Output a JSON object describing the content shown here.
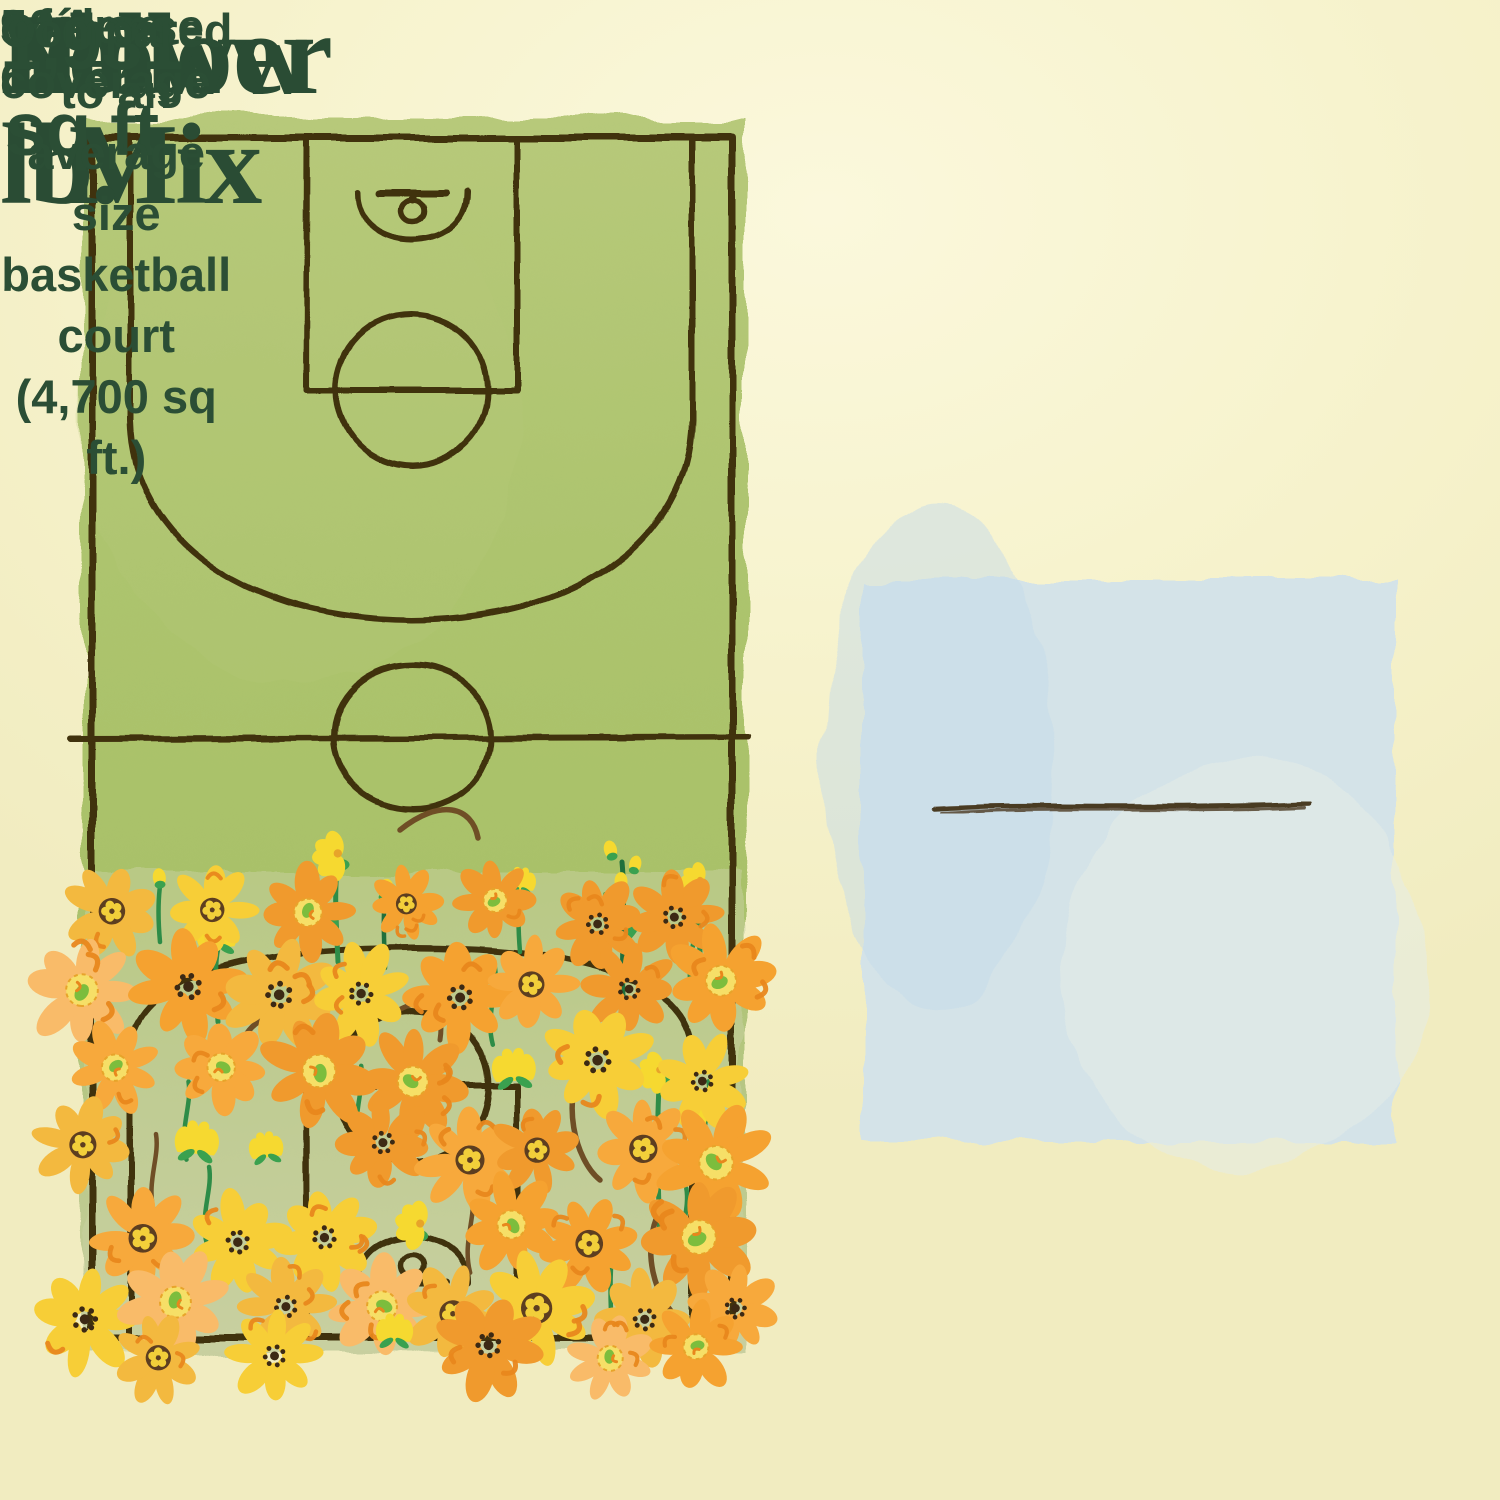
{
  "title": {
    "eyebrow": "Area Coverage:",
    "lines": [
      "Yellow",
      "Flower Mix",
      "1 lb."
    ]
  },
  "stats": {
    "value": "1,931 sq ft.",
    "value_caption": "of dense coverage",
    "comparison": "Compared to an average size basketball court (4,700 sq ft.)"
  },
  "court": {
    "length_label": "94´",
    "width_label": "50´"
  },
  "theme": {
    "bg": "#f6f2cb",
    "bg_light": "#fbf8dc",
    "bg_deep": "#f1ecc0",
    "ink": "#2b4e35",
    "ink_title": "#2a4c34"
  },
  "illustration": {
    "court_green_top": "#b7c97a",
    "court_green": "#adc46e",
    "court_green_deep": "#a9c169",
    "court_green_pale": "#c9d1a2",
    "line_brown": "#40300f",
    "box_blue": "#d4e3e8",
    "box_blue_patch": "#c6dcea",
    "box_light_patch": "#e6ede7",
    "divider_brown": "#4a3a22",
    "flower_orange": "#f5a230",
    "flower_orange_alt": "#f09a2d",
    "flower_orange_warm": "#f7a93c",
    "flower_golden": "#f3b93f",
    "flower_yellow": "#f7ce37",
    "flower_pale_orange": "#f9bb69",
    "flower_bright_yellow": "#f6d930",
    "center_brown": "#5d3e20",
    "center_dark_brown": "#3c2914",
    "center_yellow": "#f2cf3a",
    "center_ring_yellow": "#f6df67",
    "center_ring_stroke": "#e7a42a",
    "center_green": "#7cbd3d",
    "calyx_green": "#3aa14f",
    "stem_green": "#2e8c47",
    "stem_dark_green": "#1f6f3c",
    "stem_brown": "#6f4e26",
    "mark_orange": "#e8871c"
  }
}
